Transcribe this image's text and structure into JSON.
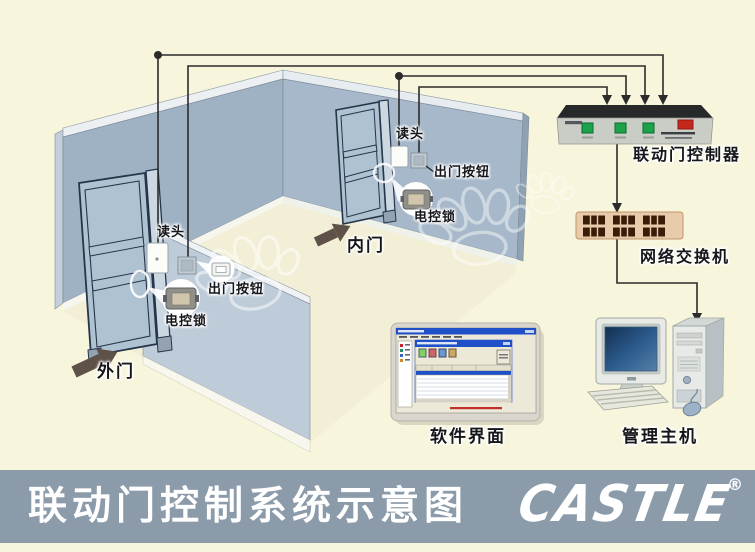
{
  "diagram": {
    "title": "联动门控制系统示意图",
    "brand": {
      "logo": "CASTLE",
      "registered": "®"
    },
    "outer_door": {
      "label": "外门",
      "reader": "读头",
      "exit_button": "出门按钮",
      "lock": "电控锁"
    },
    "inner_door": {
      "label": "内门",
      "reader": "读头",
      "exit_button": "出门按钮",
      "lock": "电控锁"
    },
    "equipment": {
      "controller": "联动门控制器",
      "network_switch": "网络交换机",
      "software_ui": "软件界面",
      "management_host": "管理主机"
    }
  },
  "colors": {
    "bg": "#F8F5DD",
    "wall": "#9FB2C4",
    "wall2": "#A6B8C9",
    "wall-light": "#BECCD9",
    "bar": "#8C9BAA",
    "wire": "#2b2b2b",
    "arrow": "#5E5147",
    "led-green": "#1CA24A",
    "switch-red": "#C5271C",
    "hub-body": "#E8CBAA",
    "screen-blue": "#1A3A63"
  }
}
